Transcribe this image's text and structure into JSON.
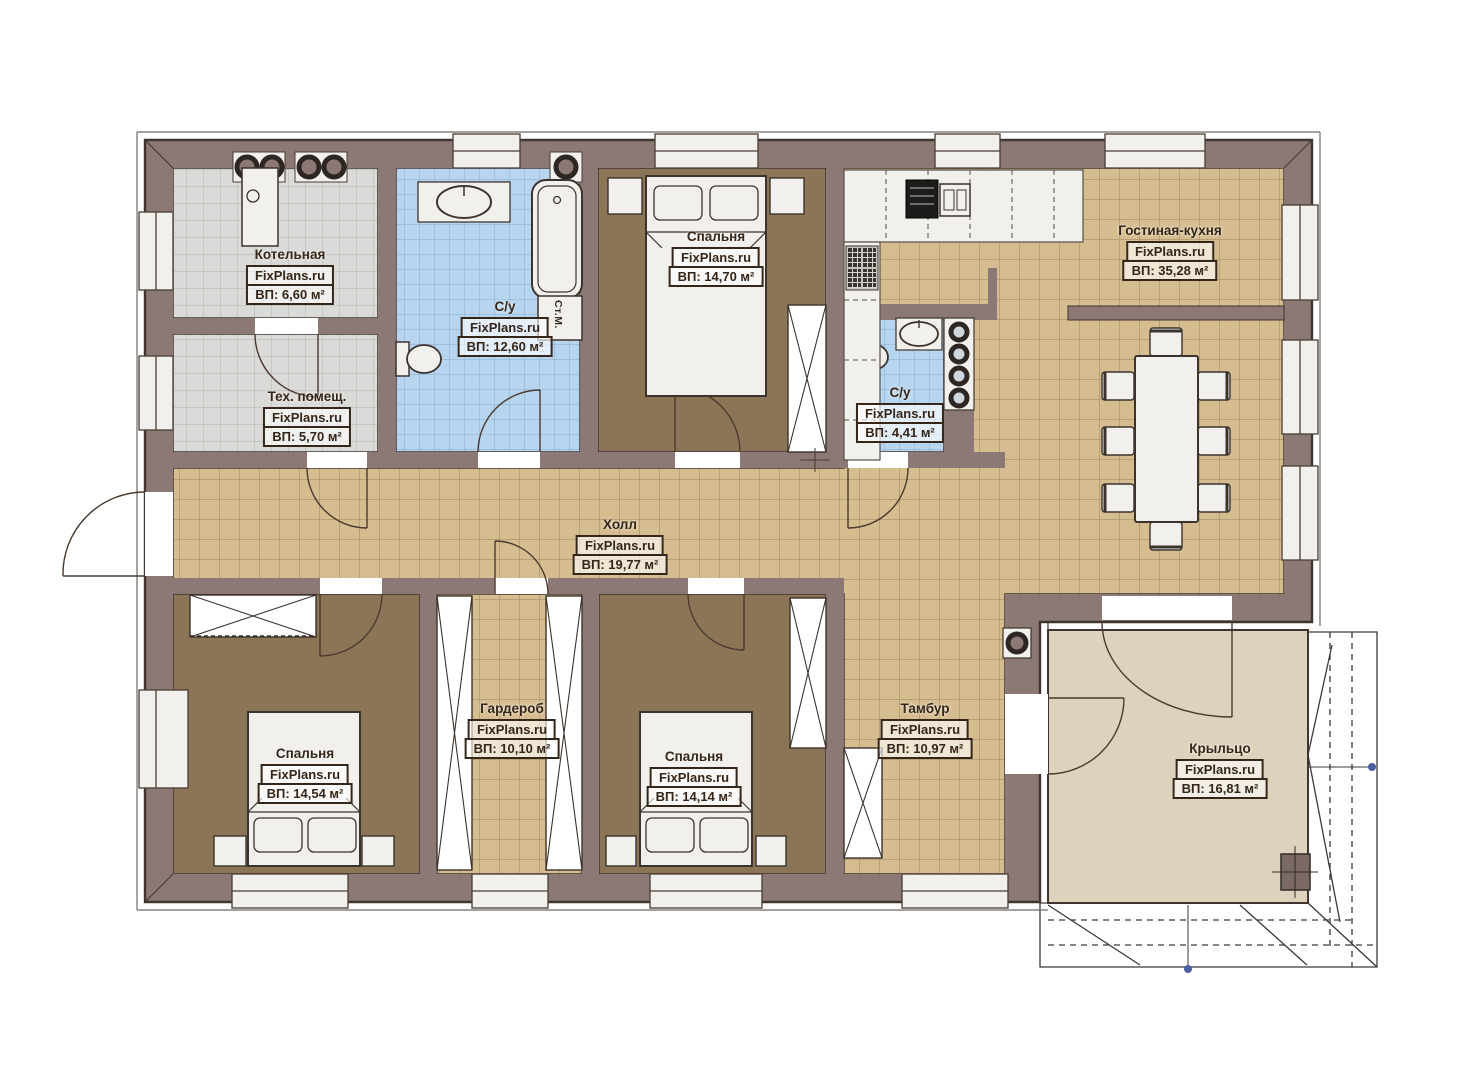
{
  "watermark": "FixPlans.ru",
  "rooms": [
    {
      "name": "Котельная",
      "area": "ВП: 6,60 м²"
    },
    {
      "name": "Тех. помещ.",
      "area": "ВП: 5,70 м²"
    },
    {
      "name": "С/у",
      "area": "ВП: 12,60 м²"
    },
    {
      "name": "Спальня",
      "area": "ВП: 14,70 м²"
    },
    {
      "name": "Гостиная-кухня",
      "area": "ВП: 35,28 м²"
    },
    {
      "name": "С/у",
      "area": "ВП: 4,41 м²"
    },
    {
      "name": "Холл",
      "area": "ВП: 19,77 м²"
    },
    {
      "name": "Гардероб",
      "area": "ВП: 10,10 м²"
    },
    {
      "name": "Спальня",
      "area": "ВП: 14,54 м²"
    },
    {
      "name": "Спальня",
      "area": "ВП: 14,14 м²"
    },
    {
      "name": "Тамбур",
      "area": "ВП: 10,97 м²"
    },
    {
      "name": "Крыльцо",
      "area": "ВП: 16,81 м²"
    }
  ],
  "annotations": {
    "washing_machine": "Ст.М."
  },
  "colors": {
    "wall": "#8c7975",
    "wall_dark": "#7b6965",
    "outline": "#413430",
    "floor_tan": "#d6bd8f",
    "tile_line_tan": "#a58d68",
    "floor_blue": "#b8d5f0",
    "tile_line_blue": "#88aacd",
    "floor_gray": "#dadad8",
    "tile_line_gray": "#b3b1ae",
    "floor_brown": "#8c7457",
    "floor_porch": "#ddd2bc",
    "fixture": "#f1f0ed",
    "label_text": "#352619",
    "accent_dot": "#4a5fa5"
  }
}
